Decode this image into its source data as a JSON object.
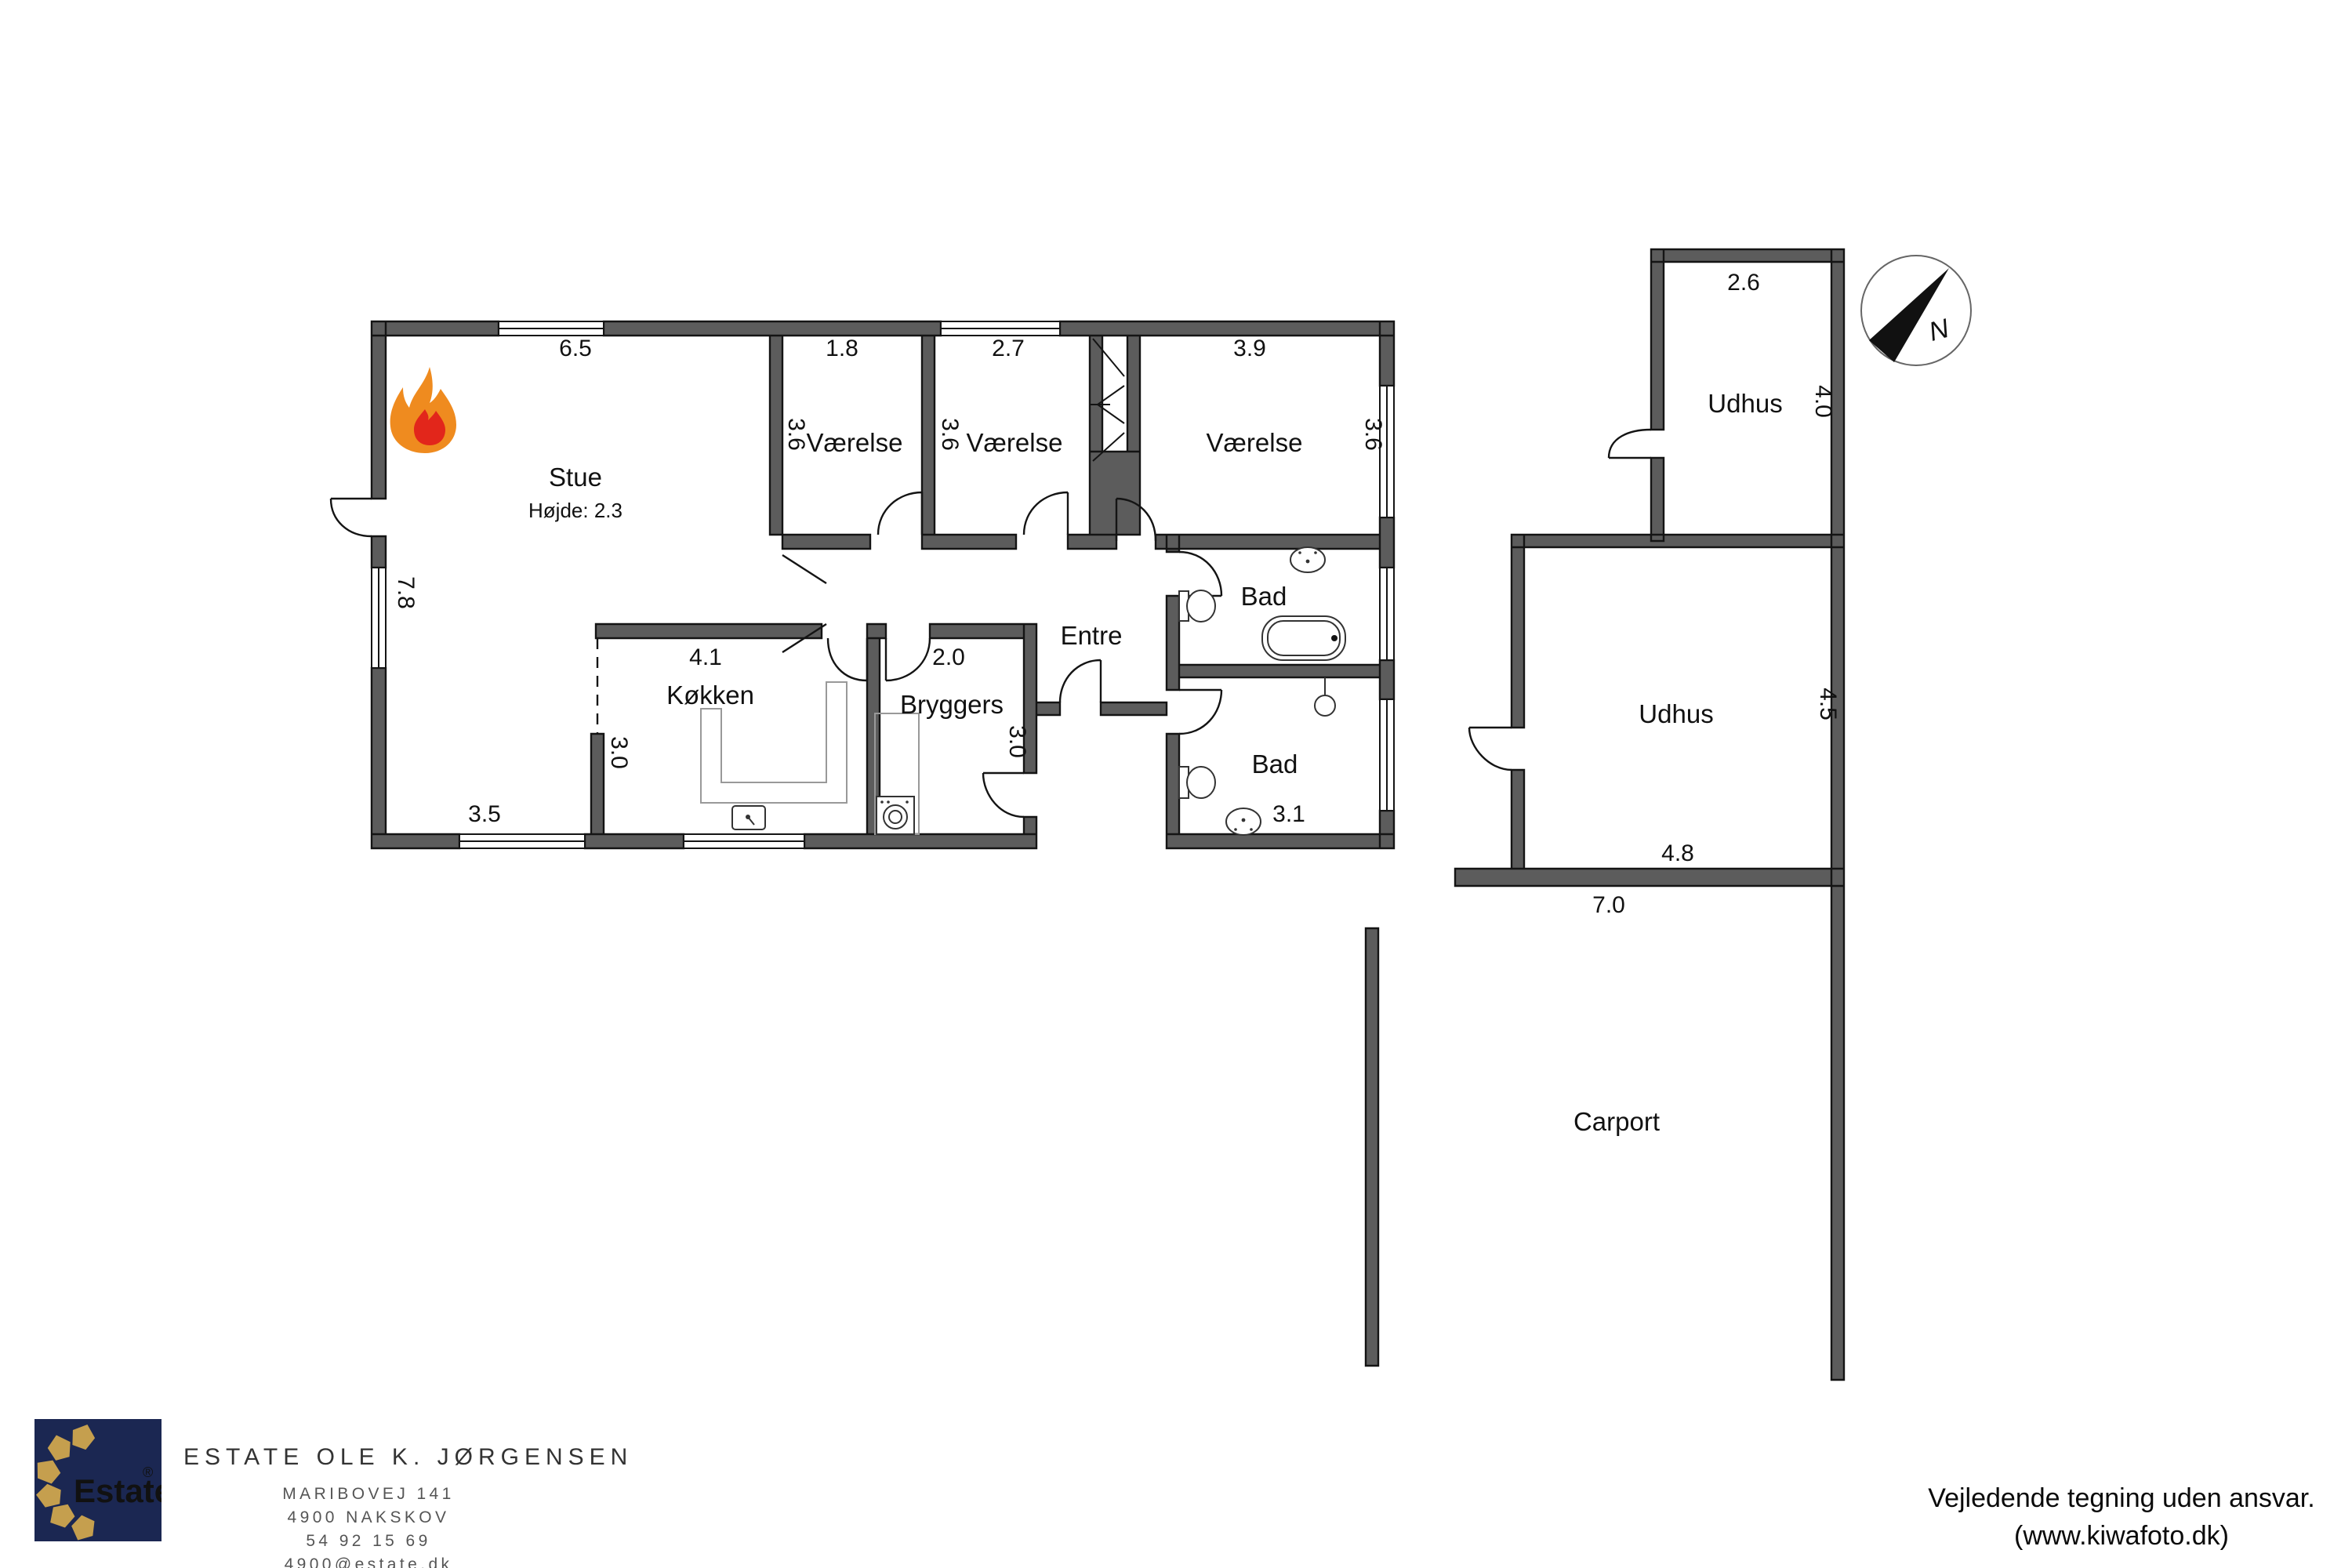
{
  "plan": {
    "stue": {
      "label": "Stue",
      "note": "Højde: 2.3",
      "dim_top": "6.5",
      "dim_left": "7.8",
      "dim_bottom": "3.5"
    },
    "vaerelse1": {
      "label": "Værelse",
      "dim_top": "1.8",
      "dim_side": "3.6"
    },
    "vaerelse2": {
      "label": "Værelse",
      "dim_top": "2.7",
      "dim_side": "3.6"
    },
    "vaerelse3": {
      "label": "Værelse",
      "dim_top": "3.9",
      "dim_side": "3.6"
    },
    "entre": {
      "label": "Entre"
    },
    "bad1": {
      "label": "Bad"
    },
    "bad2": {
      "label": "Bad",
      "dim_bottom": "3.1"
    },
    "koekken": {
      "label": "Køkken",
      "dim_top": "4.1",
      "dim_side": "3.0"
    },
    "bryggers": {
      "label": "Bryggers",
      "dim_top": "2.0",
      "dim_side": "3.0"
    },
    "udhus1": {
      "label": "Udhus",
      "dim_top": "2.6",
      "dim_side": "4.0"
    },
    "udhus2": {
      "label": "Udhus",
      "dim_bottom": "4.8",
      "dim_side": "4.5",
      "dim_wall": "7.0"
    },
    "carport": {
      "label": "Carport"
    },
    "compass_letter": "N"
  },
  "footer": {
    "logo_text": "Estate",
    "logo_reg": "®",
    "agency_name": "ESTATE OLE K. JØRGENSEN",
    "address_line1": "MARIBOVEJ 141",
    "address_line2": "4900 NAKSKOV",
    "phone": "54 92 15 69",
    "email": "4900@estate.dk",
    "disclaimer_line1": "Vejledende tegning uden ansvar.",
    "disclaimer_line2": "(www.kiwafoto.dk)"
  },
  "colors": {
    "wall": "#5c5c5c",
    "outline": "#141414",
    "logo_bg": "#1b2752",
    "logo_gold": "#c59f4e",
    "flame_outer": "#ef8b1f",
    "flame_inner": "#e2261b"
  }
}
